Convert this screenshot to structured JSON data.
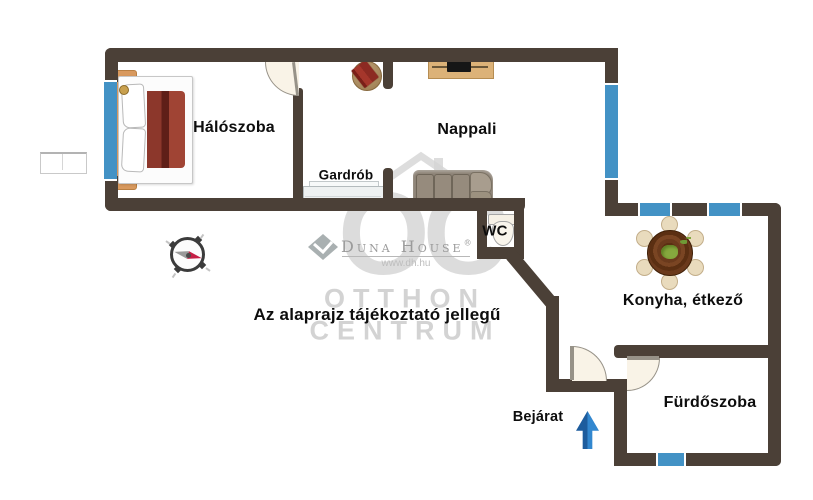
{
  "meta": {
    "type": "floor-plan",
    "canvas": {
      "width": 813,
      "height": 500,
      "background": "#ffffff"
    }
  },
  "labels": {
    "haloszoba": "Hálószoba",
    "nappali": "Nappali",
    "gardrob": "Gardrób",
    "wc": "WC",
    "konyha": "Konyha, étkező",
    "furdoszoba": "Fürdőszoba",
    "bejarat": "Bejárat"
  },
  "note": "Az alaprajz tájékoztató jellegű",
  "watermark": {
    "monogram": "OC",
    "brand": "Duna House",
    "registered": "®",
    "url": "www.dh.hu",
    "brand_line1": "OTTHON",
    "brand_line2": "CENTRUM"
  },
  "colors": {
    "wall": "#4b4037",
    "window": "#4392c5",
    "entrance_arrow": "#2b7ac2",
    "bed_blanket": "#8c372b",
    "dining_table": "#6a3a1d",
    "compass_needle_red": "#c51f45"
  },
  "icons": {
    "compass": "compass-rose-icon",
    "entrance_arrow": "up-arrow-icon",
    "bed": "double-bed",
    "wardrobe": "low-wardrobe",
    "side_table": "round-side-table-with-book",
    "tv_console": "tv-console",
    "sofa": "three-seat-sofa",
    "toilet": "toilet",
    "dining_table": "round-dining-table-six-chairs",
    "balcony": "exterior-ledge"
  }
}
